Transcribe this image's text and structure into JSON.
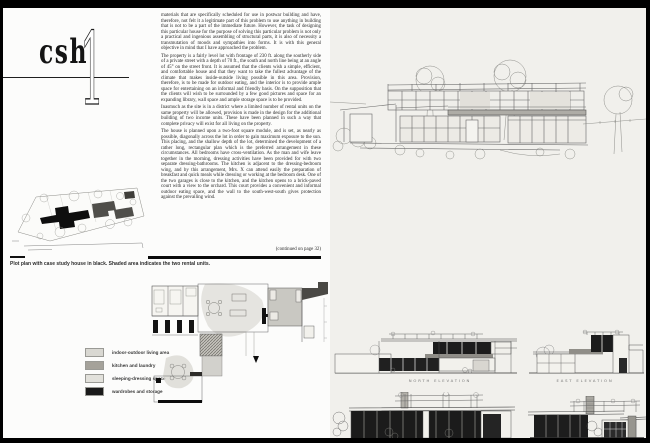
{
  "publication": {
    "logo_text": "csh",
    "issue_number": "1"
  },
  "article": {
    "paragraphs": [
      "materials that are specifically scheduled for use in postwar building and have, therefore, not felt it a legitimate part of this problem to use anything in building that is not to be a part of the immediate future. However, the task of designing this particular house for the purpose of solving this particular problem is not only a practical and ingenious assembling of structural parts, it is also of necessity a transmutation of moods and sympathies into forms. It is with this general objective in mind that I have approached the problem.",
      "The property is a fairly level lot with frontage of 230 ft. along the southerly side of a private street with a depth of 70 ft., the south and north line being at an angle of 45° on the street front. It is assumed that the clients wish a simple, efficient, and comfortable house and that they want to take the fullest advantage of the climate that makes inside-outside living possible in this area. Provision, therefore, is to be made for outdoor eating, and the interior is to provide ample space for entertaining on an informal and friendly basis. On the supposition that the clients will wish to be surrounded by a few good pictures and space for an expanding library, wall space and ample storage space is to be provided.",
      "Inasmuch as the site is in a district where a limited number of rental units on the same property will be allowed, provision is made in the design for the additional building of two income units. These have been planned in such a way that complete privacy will exist for all living on the property.",
      "The house is planned upon a two-foot square module, and is set, as nearly as possible, diagonally across the lot in order to gain maximum exposure to the sun. This placing, and the shallow depth of the lot, determined the development of a rather long, rectangular plan which is the preferred arrangement in these circumstances. All bedrooms have cross-ventilation. As the man and wife leave together in the morning, dressing activities have been provided for with two separate dressing-bathrooms. The kitchen is adjacent to the dressing-bedroom wing, and by this arrangement, Mrs. X can attend easily the preparation of breakfast and quick meals while dressing or working at the bedroom desk. One of the two garages is close to the kitchen, and the kitchen opens to a brick-paved court with a view to the orchard. This court provides a convenient and informal outdoor eating space, and the wall to the south-west-south gives protection against the prevailing wind."
    ],
    "continuation_note": "(continued on page 32)"
  },
  "site_plan": {
    "caption": "Plot plan with case study house in black.  Shaded area indicates the two rental units."
  },
  "legend": {
    "items": [
      {
        "label": "indoor-outdoor living area",
        "color": "#d9d8d2"
      },
      {
        "label": "kitchen and laundry",
        "color": "#a5a29a"
      },
      {
        "label": "sleeping-dressing space",
        "color": "#e2e1db"
      },
      {
        "label": "wardrobes and storage",
        "color": "#1a1a1a"
      }
    ]
  },
  "elevations": {
    "labels": [
      "NORTH ELEVATION",
      "EAST ELEVATION"
    ]
  },
  "colors": {
    "frame": "#000000",
    "left_page": "#fcfcfb",
    "right_page": "#f1f0ec",
    "ink": "#1c1c1c"
  }
}
